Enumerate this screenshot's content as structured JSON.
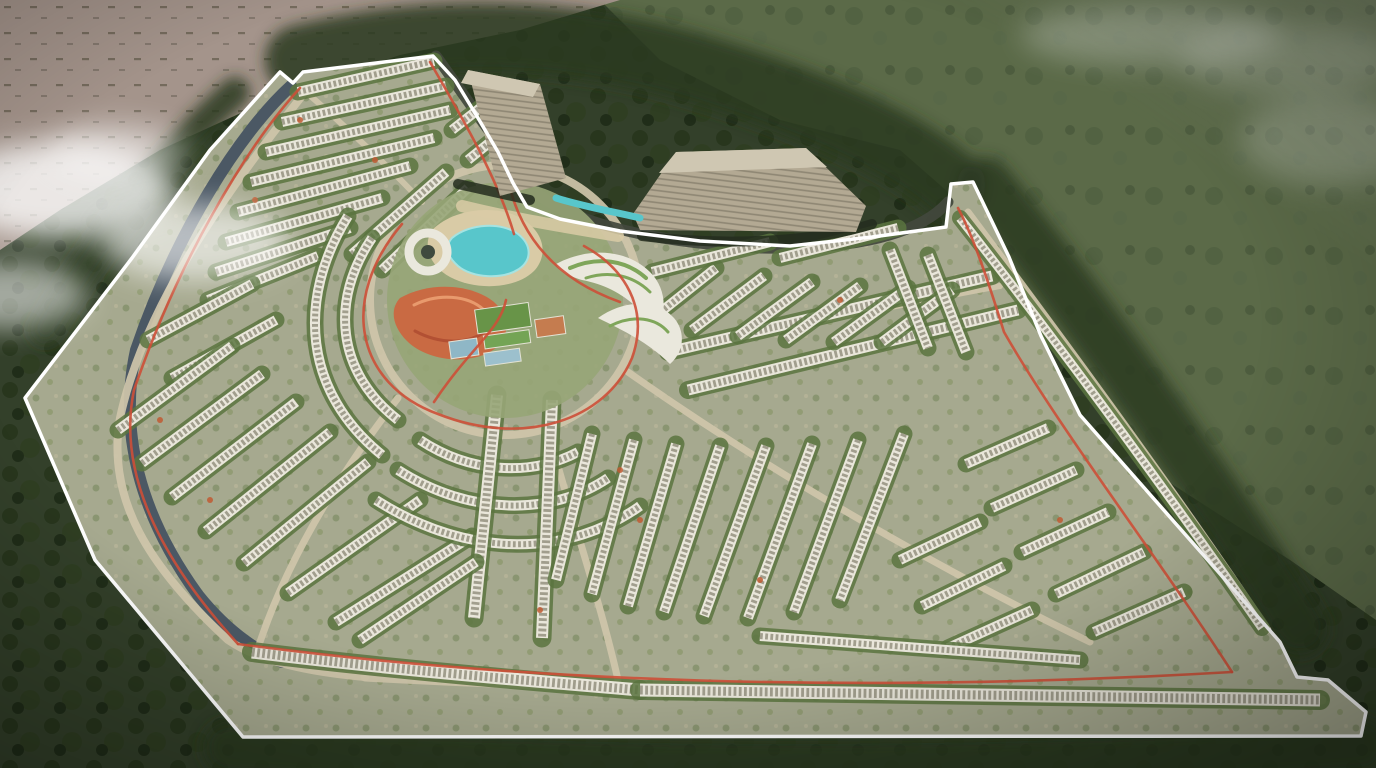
{
  "scene": {
    "palette": {
      "forest": "#33402a",
      "forestDark": "#243219",
      "field": "#5b6a48",
      "sand": "#a4948b",
      "parcel": "#a6a98f",
      "road": "#cfc6aa",
      "asphalt": "#42483d",
      "canal": "#4b5864",
      "rowBase": "#e9e6da",
      "rowDash": "#a19e8d",
      "rowGreen": "#5a7440",
      "boundary": "#ffffff",
      "track": "#cd4f37",
      "water": "#58c6cb",
      "waterLight": "#a5e3e2",
      "beach": "#d9cba6",
      "towerFace": "#b3a993",
      "towerTop": "#cfc7b2",
      "towerShadow": "#242d1f",
      "orange": "#c96a43",
      "orangeLight": "#e89a6d",
      "orangeDark": "#b25033",
      "pitch": "#689448",
      "pitch2": "#74a455",
      "courtBlue": "#8fb7c6",
      "courtBlue2": "#9cc0cd",
      "clay": "#c57c4f",
      "canopy": "#eae8dd",
      "canopyGreen": "#7fa65a",
      "treeBelt": "#2c3a22",
      "accent": "#bf5a33",
      "cloud": "#ffffff",
      "parkBase": "#97a577",
      "ringHole": "#3f4a3e"
    },
    "boundary": {
      "points": "280,72 293,83 303,72 433,56 455,80 478,118 498,152 513,183 527,207 560,219 620,231 700,241 790,246 872,237 946,227 951,184 973,182 1009,257 1041,336 1080,415 1280,642 1297,677 1328,680 1366,712 1361,736 243,737 95,560 25,398 132,258 210,150"
    },
    "canal": {
      "d": "M291,86 C240,132 175,235 136,350 C118,432 140,515 198,595 C222,625 250,648 282,662",
      "w": 12
    },
    "roads": [
      {
        "d": "M370,300 a135,135 0 1 0 270,0 a135,135 0 1 0 -270,0",
        "w": 8,
        "c": "road"
      },
      {
        "d": "M302,96 C215,205 142,315 120,418 C106,500 150,568 228,640 C260,662 310,672 365,677",
        "w": 8,
        "c": "road"
      },
      {
        "d": "M365,677 C600,690 900,695 1322,700",
        "w": 9,
        "c": "road"
      },
      {
        "d": "M306,92 C355,135 392,170 422,202",
        "w": 6,
        "c": "road"
      },
      {
        "d": "M398,398 C335,480 285,565 258,648",
        "w": 7,
        "c": "road"
      },
      {
        "d": "M548,430 C572,520 600,600 618,680",
        "w": 7,
        "c": "road"
      },
      {
        "d": "M628,372 C760,465 930,565 1090,642",
        "w": 7,
        "c": "road"
      },
      {
        "d": "M655,348 C790,330 920,300 1000,286",
        "w": 6,
        "c": "road"
      },
      {
        "d": "M968,212 C1060,335 1185,505 1268,630",
        "w": 7,
        "c": "road"
      },
      {
        "d": "M436,56 C468,100 500,150 540,196 C580,224 650,242 760,248 C855,250 920,234 948,202",
        "w": 11,
        "c": "asphalt"
      }
    ],
    "rows": [
      {
        "d": "M298,92 L434,61"
      },
      {
        "d": "M282,122 L446,86"
      },
      {
        "d": "M266,152 L450,110"
      },
      {
        "d": "M251,182 L434,138"
      },
      {
        "d": "M238,212 L410,166"
      },
      {
        "d": "M226,242 L382,198"
      },
      {
        "d": "M216,272 L350,228"
      },
      {
        "d": "M208,300 L318,256"
      },
      {
        "d": "M148,340 L252,284"
      },
      {
        "d": "M172,378 L276,320"
      },
      {
        "d": "M352,254 L446,172"
      },
      {
        "d": "M382,270 L468,188"
      },
      {
        "d": "M452,130 L508,86"
      },
      {
        "d": "M468,160 L520,118"
      },
      {
        "d": "M118,430 L232,346"
      },
      {
        "d": "M142,463 L262,374"
      },
      {
        "d": "M172,497 L296,402"
      },
      {
        "d": "M206,531 L330,432"
      },
      {
        "d": "M244,563 L368,462"
      },
      {
        "d": "M288,593 L420,500"
      },
      {
        "d": "M336,622 L472,536"
      },
      {
        "d": "M372,238 C330,300 336,372 398,420"
      },
      {
        "d": "M348,216 C296,300 304,392 382,455"
      },
      {
        "d": "M420,440 C470,473 530,477 578,452"
      },
      {
        "d": "M398,470 C470,516 552,516 608,478"
      },
      {
        "d": "M376,500 C470,560 570,556 640,506"
      },
      {
        "d": "M497,395 L474,618",
        "w": 12
      },
      {
        "d": "M552,400 L542,638",
        "w": 12
      },
      {
        "d": "M592,434 L556,580"
      },
      {
        "d": "M634,440 L592,594"
      },
      {
        "d": "M676,444 L628,606"
      },
      {
        "d": "M720,446 L664,612"
      },
      {
        "d": "M766,446 L704,616"
      },
      {
        "d": "M812,444 L748,618"
      },
      {
        "d": "M858,440 L794,612"
      },
      {
        "d": "M904,434 L840,600"
      },
      {
        "d": "M966,464 L1048,428"
      },
      {
        "d": "M992,508 L1076,470"
      },
      {
        "d": "M1022,552 L1108,512"
      },
      {
        "d": "M1056,594 L1144,552"
      },
      {
        "d": "M1094,632 L1184,592"
      },
      {
        "d": "M900,560 L980,522"
      },
      {
        "d": "M922,606 L1004,566"
      },
      {
        "d": "M948,648 L1032,610"
      },
      {
        "d": "M668,352 L992,276",
        "w": 11
      },
      {
        "d": "M688,390 L1018,310",
        "w": 11
      },
      {
        "d": "M648,322 L716,268"
      },
      {
        "d": "M692,330 L764,276"
      },
      {
        "d": "M738,336 L812,282"
      },
      {
        "d": "M786,340 L860,286"
      },
      {
        "d": "M834,342 L908,288"
      },
      {
        "d": "M882,342 L952,290"
      },
      {
        "d": "M890,250 L928,348"
      },
      {
        "d": "M928,255 L966,352"
      },
      {
        "d": "M652,272 L770,242"
      },
      {
        "d": "M780,258 L898,228"
      },
      {
        "d": "M960,218 C1060,345 1180,510 1262,628",
        "w": 9
      },
      {
        "d": "M252,652 C380,668 520,680 640,690",
        "w": 13
      },
      {
        "d": "M640,690 L1320,700",
        "w": 13
      },
      {
        "d": "M760,636 L1080,660",
        "w": 10
      },
      {
        "d": "M360,640 L476,562"
      }
    ],
    "tracks": [
      {
        "d": "M300,88 C245,148 178,262 134,390 C118,466 152,550 238,644"
      },
      {
        "d": "M430,62 C466,124 498,180 514,234"
      },
      {
        "d": "M238,644 C520,682 860,694 1232,672"
      },
      {
        "d": "M1232,672 C1160,560 1060,430 1004,332 C986,274 972,234 958,208"
      },
      {
        "d": "M402,224 C338,300 356,384 438,414 C524,448 606,420 632,358 C650,308 624,268 584,246"
      },
      {
        "d": "M508,180 C522,244 564,282 620,302"
      },
      {
        "d": "M434,402 C470,348 500,330 506,300"
      }
    ],
    "amenity": {
      "beach": "M432,230 C455,207 500,204 524,220 C545,234 548,256 534,271 C516,289 476,291 450,277 C430,266 422,246 432,230 Z",
      "lagoon": "M452,238 C470,223 502,222 518,234 C532,245 532,260 519,269 C502,280 472,278 458,266 C447,256 444,247 452,238 Z",
      "orange": "M400,298 C430,281 472,284 494,302 C512,318 510,340 490,352 C463,366 425,359 407,341 C393,327 389,310 400,298 Z",
      "swirl1": "M414,305 C438,293 468,295 484,310",
      "swirl2": "M415,331 C441,345 469,344 486,331",
      "club1": "M556,264 C590,246 628,250 650,272 C666,288 668,312 656,332 C640,304 614,286 582,280 C568,276 558,270 556,264 Z",
      "club2": "M598,318 C626,298 658,300 674,318 C686,332 684,352 670,364 C648,342 622,330 598,318 Z",
      "clubGreen1": "M570,268 C598,256 626,260 646,278",
      "clubGreen2": "M586,278 C610,270 634,276 650,292",
      "clubGreen3": "M610,326 C634,314 656,318 668,332",
      "plaza": "M462,206 C510,218 560,226 618,236",
      "pond": "M556,198 C585,207 615,212 640,218",
      "courts": [
        {
          "x": 478,
          "y": 306,
          "w": 54,
          "h": 24,
          "c": "pitch"
        },
        {
          "x": 483,
          "y": 333,
          "w": 46,
          "h": 13,
          "c": "pitch2"
        },
        {
          "x": 448,
          "y": 334,
          "w": 28,
          "h": 17,
          "c": "courtBlue"
        },
        {
          "x": 481,
          "y": 350,
          "w": 36,
          "h": 13,
          "c": "courtBlue2"
        },
        {
          "x": 536,
          "y": 324,
          "w": 29,
          "h": 18,
          "c": "clay"
        }
      ]
    },
    "towers": {
      "t1Face": "468,70 540,84 566,178 500,196",
      "t1Top": "468,70 540,84 533,97 461,83",
      "t2Face": "633,214 676,152 806,148 866,206 856,232 640,230",
      "t2Top": "676,152 806,148 827,167 659,173",
      "shadow1": "M458,184 L530,200",
      "shadow2": "M642,236 C730,247 820,241 872,224"
    },
    "belts": [
      {
        "d": "M300,60 C420,30 560,28 700,70 C800,100 900,140 950,185",
        "w": 70
      },
      {
        "d": "M985,185 C1080,300 1200,470 1300,628",
        "w": 55
      },
      {
        "d": "M230,748 C600,770 1000,772 1360,746",
        "w": 55
      },
      {
        "d": "M235,92 C160,160 95,245 45,330",
        "w": 30
      }
    ],
    "clouds": [
      {
        "cx": 60,
        "cy": 190,
        "rx": 115,
        "ry": 48,
        "o": 0.78
      },
      {
        "cx": 195,
        "cy": 242,
        "rx": 95,
        "ry": 38,
        "o": 0.6
      },
      {
        "cx": 8,
        "cy": 295,
        "rx": 80,
        "ry": 34,
        "o": 0.55
      },
      {
        "cx": 120,
        "cy": 150,
        "rx": 70,
        "ry": 26,
        "o": 0.45
      },
      {
        "cx": 1150,
        "cy": 35,
        "rx": 130,
        "ry": 30,
        "o": 0.25
      },
      {
        "cx": 1330,
        "cy": 140,
        "rx": 90,
        "ry": 45,
        "o": 0.2
      },
      {
        "cx": 1290,
        "cy": 60,
        "rx": 110,
        "ry": 35,
        "o": 0.18
      }
    ],
    "accents": [
      [
        300,
        120
      ],
      [
        255,
        200
      ],
      [
        375,
        160
      ],
      [
        160,
        420
      ],
      [
        210,
        500
      ],
      [
        430,
        330
      ],
      [
        540,
        610
      ],
      [
        840,
        300
      ],
      [
        760,
        580
      ],
      [
        1060,
        520
      ],
      [
        620,
        470
      ],
      [
        640,
        520
      ]
    ]
  }
}
